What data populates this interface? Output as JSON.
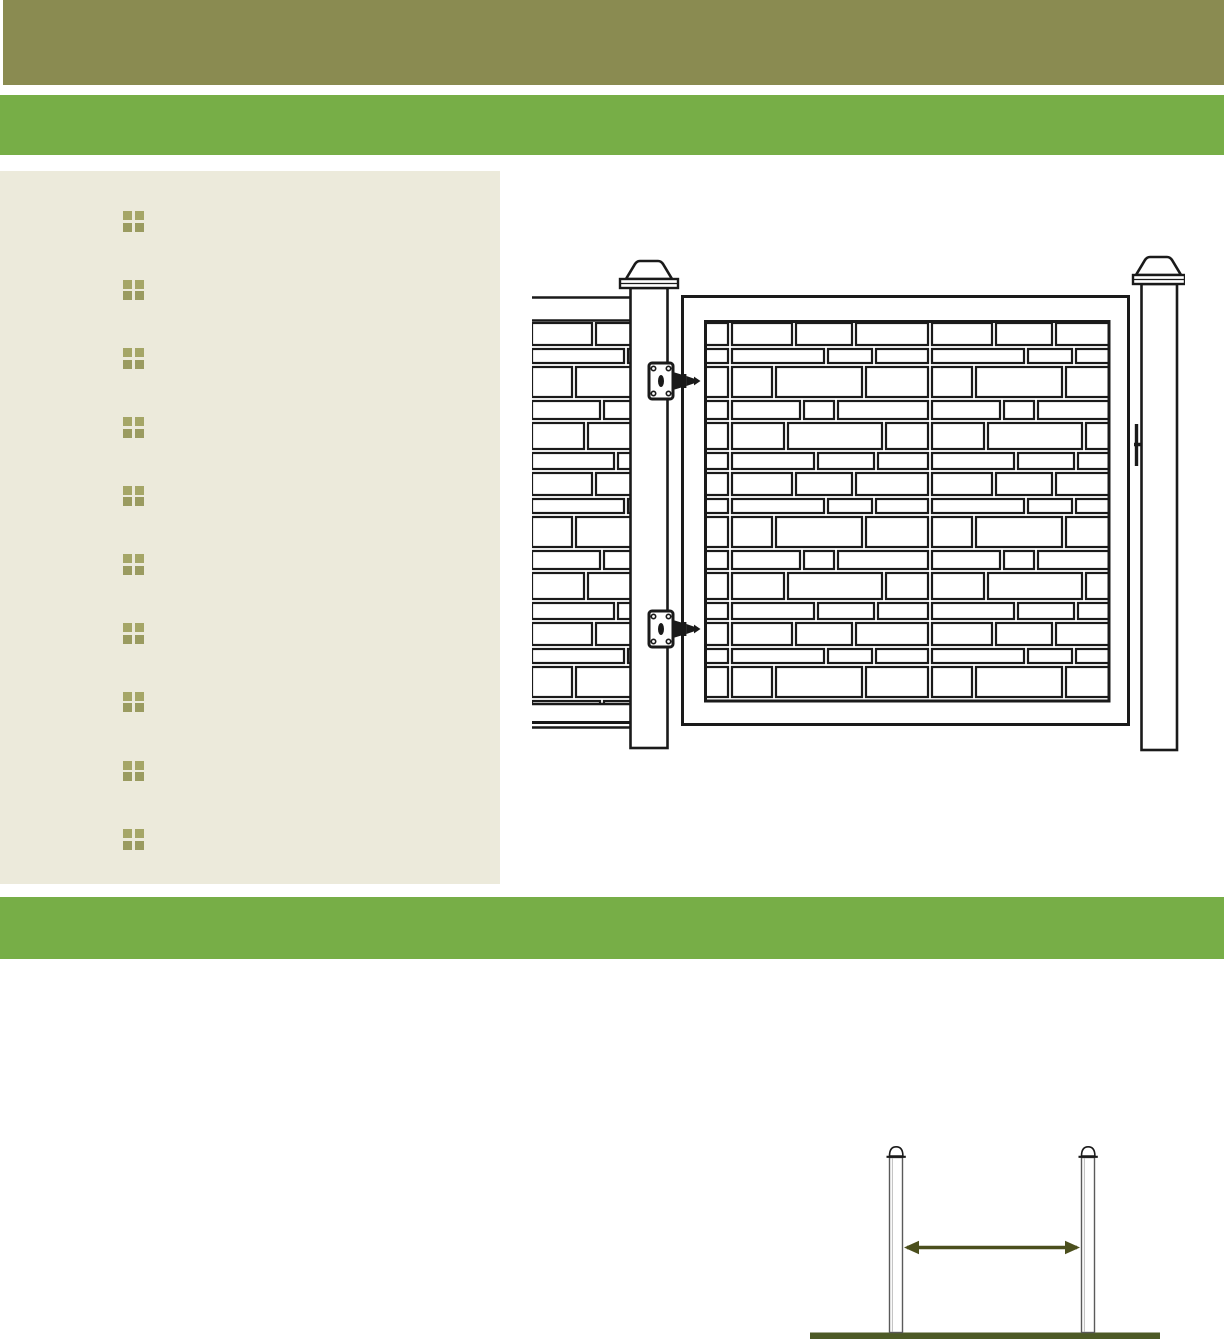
{
  "colors": {
    "page_bg": "#FFFFFF",
    "banner_olive": "#8A8B51",
    "band_green": "#77AE47",
    "panel_beige": "#ECEADB",
    "bullet_olive": "#9A9B60",
    "ink": "#1A1A1A",
    "arrow_olive": "#4B4F1D",
    "ground_olive": "#4D5A26",
    "post_gray": "#5A5A5A"
  },
  "panel": {
    "bullet_count": 10,
    "bullet_icon": "grid-bullet-icon"
  },
  "illustrations": {
    "gate": "stone-panel-gate-line-drawing",
    "spacing": "post-spacing-line-drawing"
  }
}
